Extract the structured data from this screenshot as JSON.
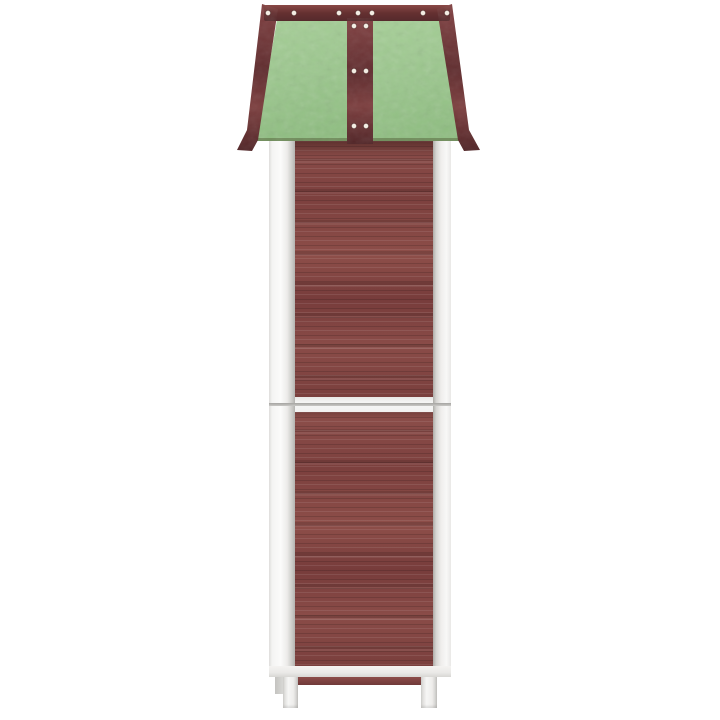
{
  "meta": {
    "type": "product-photo",
    "view": "side",
    "description": "Side view of a tall narrow wooden garden tool shed on a plain white background: pitched sage-green roof with flared eaves, dark red-brown wood trim battens fastened with white screws, walls of horizontal red-brown planks framed by white posts, a white horizontal divider between upper and lower cabinet modules, and short white legs.",
    "background": "#ffffff"
  },
  "palette": {
    "bg": "#ffffff",
    "roof-green": "#9cc78e",
    "roof-green-light": "#abd29c",
    "roof-green-dark": "#8ab97c",
    "trim": "#713738",
    "trim-light": "#8c4b49",
    "trim-dark": "#552a2c",
    "wood": "#854946",
    "wood-light": "#9a5a54",
    "wood-dark": "#6b3736",
    "frame-white": "#f6f6f5",
    "frame-shadow": "#cfcecb",
    "frame-seam": "#c3c2bf",
    "screw": "#f3ede3"
  },
  "roof": {
    "ridge_screws": {
      "y": 13,
      "x": [
        268,
        294,
        339,
        358,
        372,
        423,
        447
      ]
    },
    "batten_screw_pairs": {
      "x": [
        354,
        366
      ],
      "y": [
        26,
        71,
        126
      ]
    },
    "screw_radius": 2.6
  },
  "product": {
    "components": {
      "roof": {
        "shape": "pitched with flared eave tips",
        "panel_color": "#9cc78e",
        "trim_color": "#713738",
        "screw_color": "#f3ede3",
        "panels_visible": 2,
        "battens_visible": [
          "ridge-cap",
          "left-edge",
          "center",
          "right-edge"
        ]
      },
      "walls": {
        "material": "horizontal wood planks",
        "color": "#854946",
        "sections_visible": 2
      },
      "frame": {
        "color": "#f6f6f5",
        "posts_visible": 2,
        "rails_visible": [
          "mid-divider",
          "bottom"
        ]
      },
      "legs": {
        "count_visible": 3,
        "color": "#f0efed"
      },
      "bottom_back_rail": {
        "color": "#7d403f"
      }
    }
  }
}
